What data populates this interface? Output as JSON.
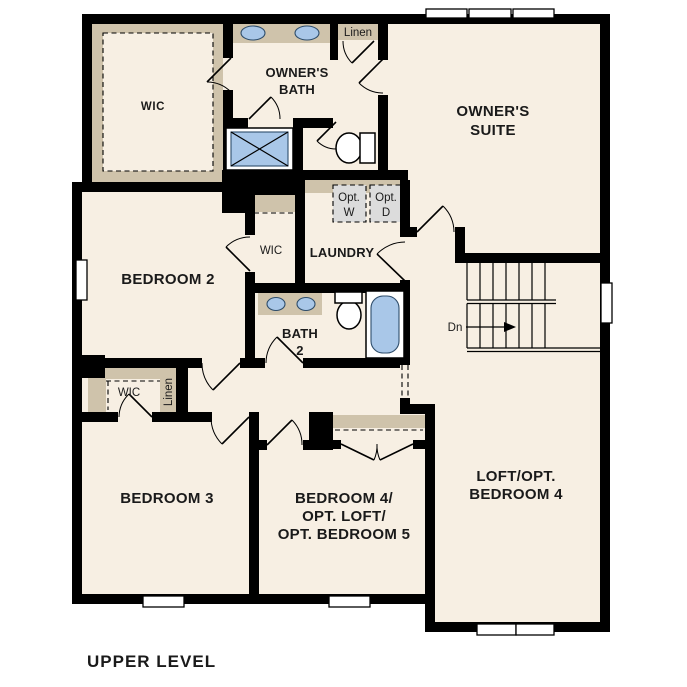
{
  "title": "UPPER LEVEL",
  "colors": {
    "background": "#ffffff",
    "floor": "#f7efe3",
    "wall": "#000000",
    "trim": "#cfc3ab",
    "fixture_blue": "#a9c7e8",
    "appliance_gray": "#dcdcdc"
  },
  "labels": {
    "owners_wic": "WIC",
    "owners_bath": [
      "OWNER'S",
      "BATH"
    ],
    "linen_upper": "Linen",
    "owners_suite": [
      "OWNER'S",
      "SUITE"
    ],
    "opt_washer": [
      "Opt.",
      "W"
    ],
    "opt_dryer": [
      "Opt.",
      "D"
    ],
    "laundry": "LAUNDRY",
    "bedroom2_wic": "WIC",
    "bedroom2": "BEDROOM 2",
    "bath2": [
      "BATH",
      "2"
    ],
    "stairs_down": "Dn",
    "bedroom3_wic": "WIC",
    "hall_linen": "Linen",
    "bedroom3": "BEDROOM 3",
    "bedroom4": [
      "BEDROOM 4/",
      "OPT. LOFT/",
      "OPT. BEDROOM 5"
    ],
    "loft": [
      "LOFT/OPT.",
      "BEDROOM 4"
    ]
  }
}
